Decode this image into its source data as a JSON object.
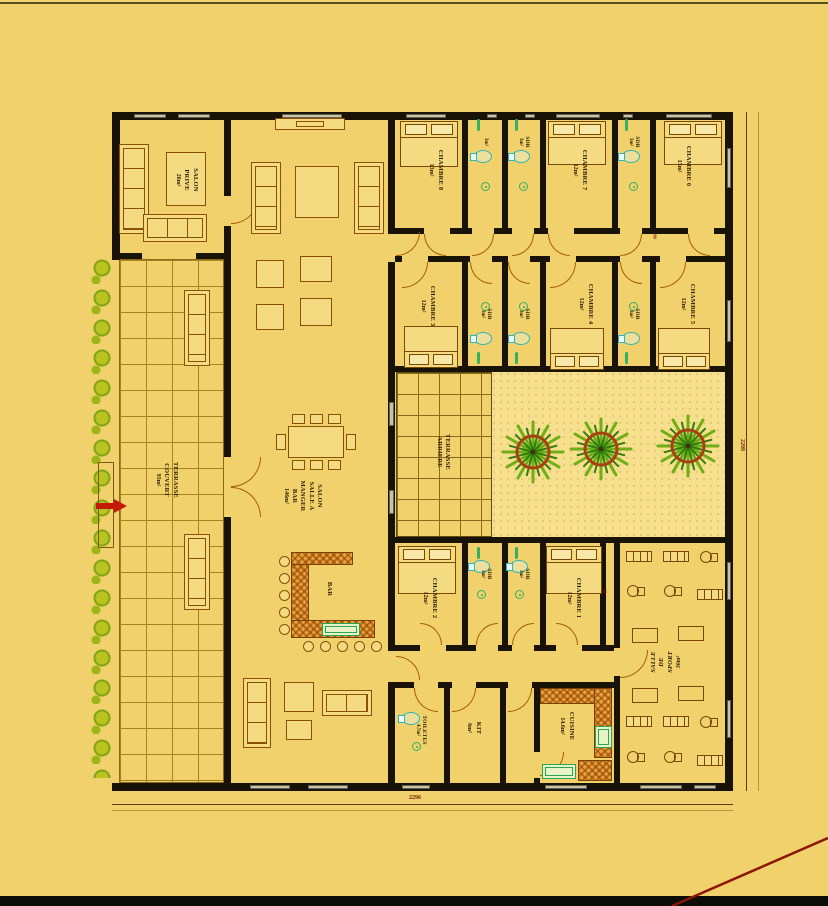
{
  "plan": {
    "rooms": {
      "salon_prive": {
        "name": "SALON\nPRIVE",
        "area": "26m²"
      },
      "terrasse_couvert": {
        "name": "TERRASSE\nCOUVERT",
        "area": "93m²"
      },
      "salon": {
        "name": "SALON\nSALLE A\nMANGER\nBAR",
        "area": "146m²"
      },
      "terrasse_arriere": {
        "name": "TERRASSE\nARRIERE",
        "area": ""
      },
      "chambre_8": {
        "name": "CHAMBRE 8",
        "area": "13m²"
      },
      "chambre_7": {
        "name": "CHAMBRE 7",
        "area": "12m²"
      },
      "chambre_6": {
        "name": "CHAMBRE 6",
        "area": "13m²"
      },
      "chambre_5": {
        "name": "CHAMBRE 5",
        "area": "12m²"
      },
      "chambre_4": {
        "name": "CHAMBRE 4",
        "area": "12m²"
      },
      "chambre_3": {
        "name": "CHAMBRE 3",
        "area": "12m²"
      },
      "chambre_2": {
        "name": "CHAMBRE 2",
        "area": "12m²"
      },
      "chambre_1": {
        "name": "CHAMBRE 1",
        "area": "12m²"
      },
      "sdb": {
        "name": "SDB",
        "area": "3m²"
      },
      "salle_sport": {
        "name": "SALLE\nDE\nSPORT",
        "area": "36m²"
      },
      "toiletes": {
        "name": "TOILETES",
        "area": "4.7m²"
      },
      "kit": {
        "name": "KIT",
        "area": "6m²"
      },
      "cuisine": {
        "name": "CUISINE",
        "area": "14.6m²"
      },
      "bar": {
        "name": "BAR"
      }
    },
    "dimensions": {
      "width_total": "2296",
      "height_total": "2298",
      "door_width": "90"
    },
    "colors": {
      "background": "#f1d16c",
      "courtyard": "#f6df8d",
      "wall": "#181207",
      "furniture_line": "#8a5200",
      "door_arc": "#a55f00",
      "fixture_green": "#35b060",
      "toilet_teal": "#2fb6b6",
      "bush_green": "#b9c421",
      "palm_ring": "#a84010",
      "arrow_red": "#c41a08",
      "dimension_red": "#70200a"
    }
  }
}
